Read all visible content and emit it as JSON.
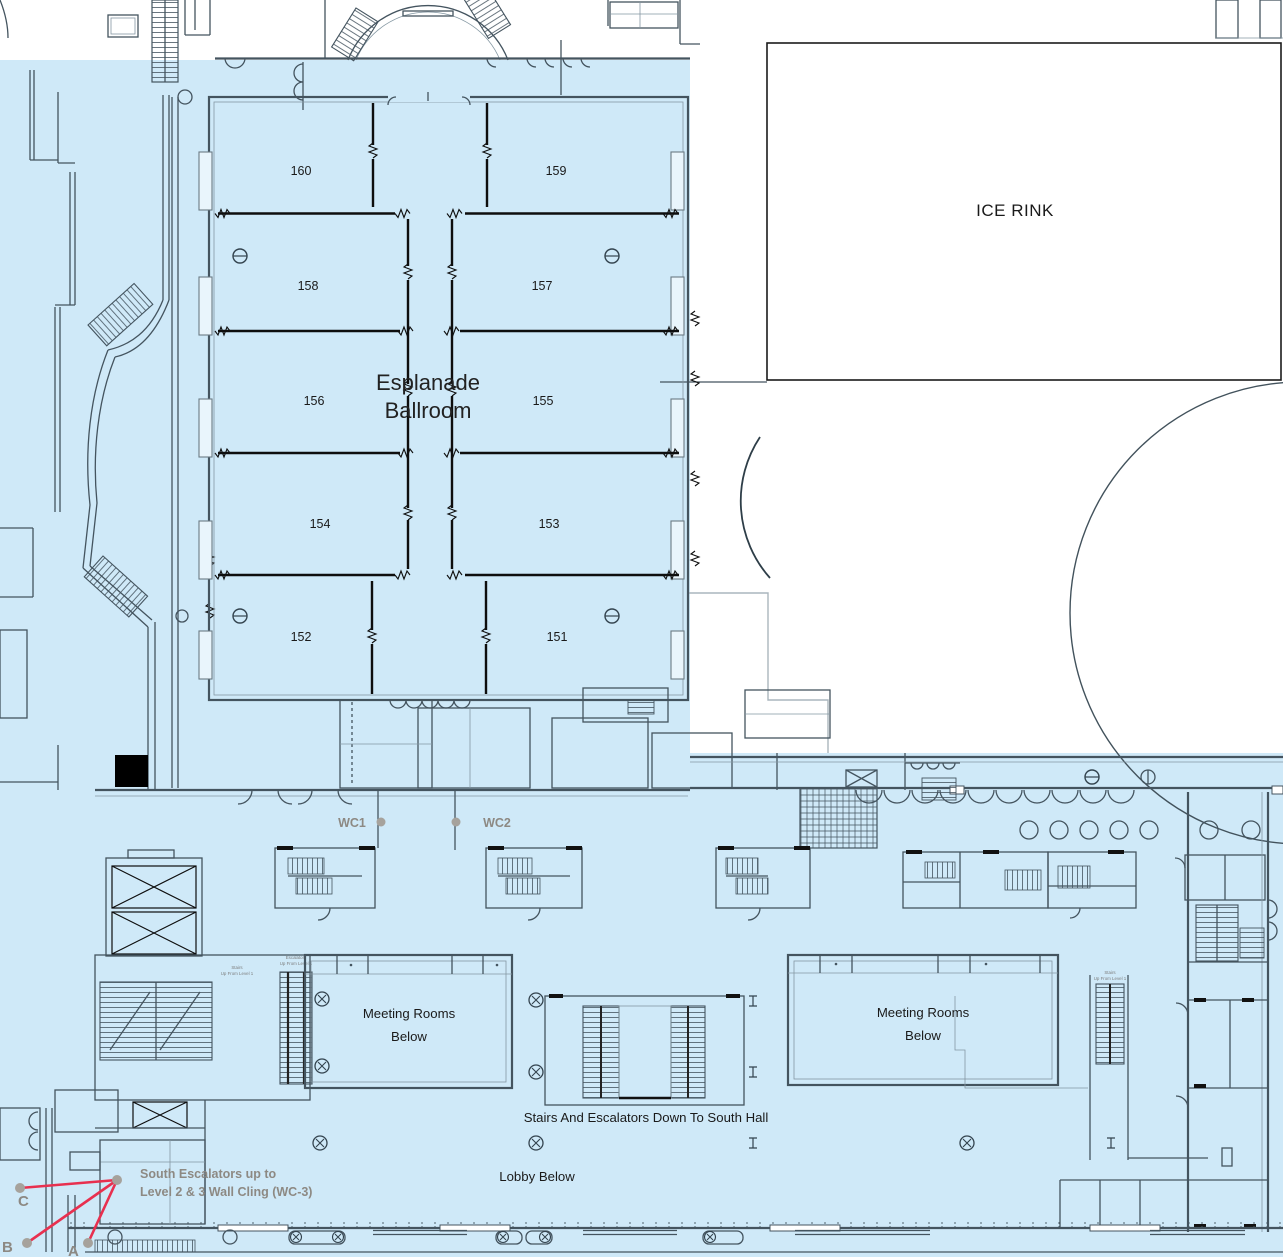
{
  "plan": {
    "ballroom": {
      "title_line1": "Esplanade",
      "title_line2": "Ballroom",
      "rooms": [
        "160",
        "159",
        "158",
        "157",
        "156",
        "155",
        "154",
        "153",
        "152",
        "151"
      ]
    },
    "ice_rink": {
      "label": "ICE RINK"
    },
    "restrooms": {
      "wc1": "WC1",
      "wc2": "WC2"
    },
    "lower_level": {
      "meeting_rooms_left_line1": "Meeting Rooms",
      "meeting_rooms_left_line2": "Below",
      "meeting_rooms_right_line1": "Meeting Rooms",
      "meeting_rooms_right_line2": "Below",
      "stairs_south_label": "Stairs And Escalators Down To South Hall",
      "lobby_label": "Lobby Below"
    },
    "tiny_labels": {
      "stairs": "Stairs",
      "escalators": "Escalators",
      "up_from_level_1": "Up From Level 1"
    },
    "annotation": {
      "line1": "South Escalators up to",
      "line2": "Level 2 & 3 Wall Cling (WC-3)",
      "marker_a": "A",
      "marker_b": "B",
      "marker_c": "C"
    },
    "colors": {
      "floor_blue": "#cfe9f8",
      "wall": "#44545f",
      "partition": "#0e0e0e",
      "annotation_red": "#e8304f",
      "annotation_gray": "#8d8983"
    }
  }
}
